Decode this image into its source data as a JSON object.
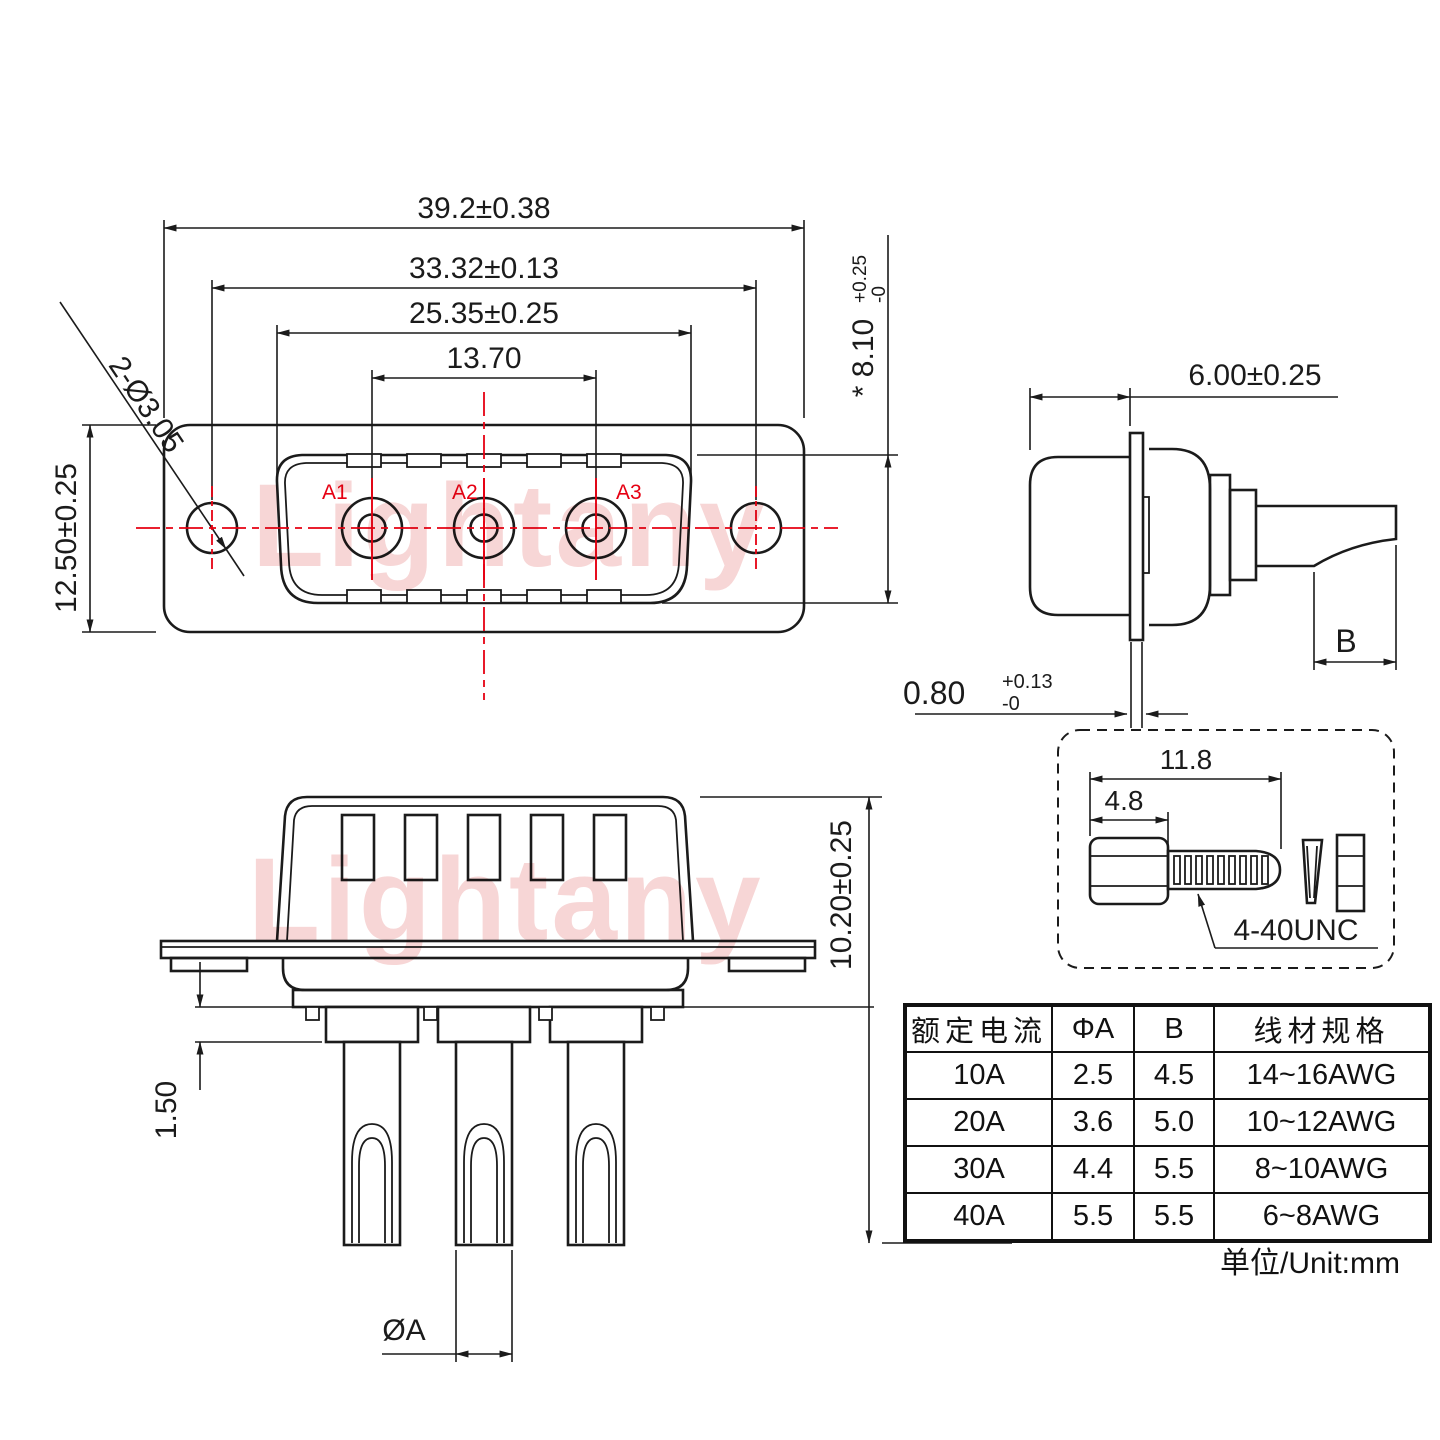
{
  "watermark": {
    "text": "Lightany"
  },
  "colors": {
    "line": "#1b1b1b",
    "red": "#e60012",
    "watermark_pink": "#f7d6d6"
  },
  "front_view": {
    "dim_flange_width": "39.2±0.38",
    "dim_hole_spacing": "33.32±0.13",
    "dim_shell_width": "25.35±0.25",
    "dim_contact_span": "13.70",
    "callout_mounting_holes": "2-Ø3.05",
    "dim_flange_height": "12.50±0.25",
    "dim_shell_height": "* 8.10",
    "dim_shell_height_tol_plus": "+0.25",
    "dim_shell_height_tol_minus": "-0",
    "contact_labels": [
      "A1",
      "A2",
      "A3"
    ]
  },
  "side_view": {
    "dim_body_depth": "6.00±0.25",
    "dim_flange_thickness": "0.80",
    "dim_flange_tol_plus": "+0.13",
    "dim_flange_tol_minus": "-0",
    "dim_solder_cup": "B"
  },
  "screw_detail": {
    "dim_overall_length": "11.8",
    "dim_head_length": "4.8",
    "thread_spec": "4-40UNC"
  },
  "bottom_view": {
    "dim_body_height": "10.20±0.25",
    "dim_standoff": "1.50",
    "dim_pin_diameter": "ØA"
  },
  "spec_table": {
    "headers": [
      "额定电流",
      "ΦA",
      "B",
      "线材规格"
    ],
    "rows": [
      [
        "10A",
        "2.5",
        "4.5",
        "14~16AWG"
      ],
      [
        "20A",
        "3.6",
        "5.0",
        "10~12AWG"
      ],
      [
        "30A",
        "4.4",
        "5.5",
        "8~10AWG"
      ],
      [
        "40A",
        "5.5",
        "5.5",
        "6~8AWG"
      ]
    ]
  },
  "unit_note": "单位/Unit:mm"
}
